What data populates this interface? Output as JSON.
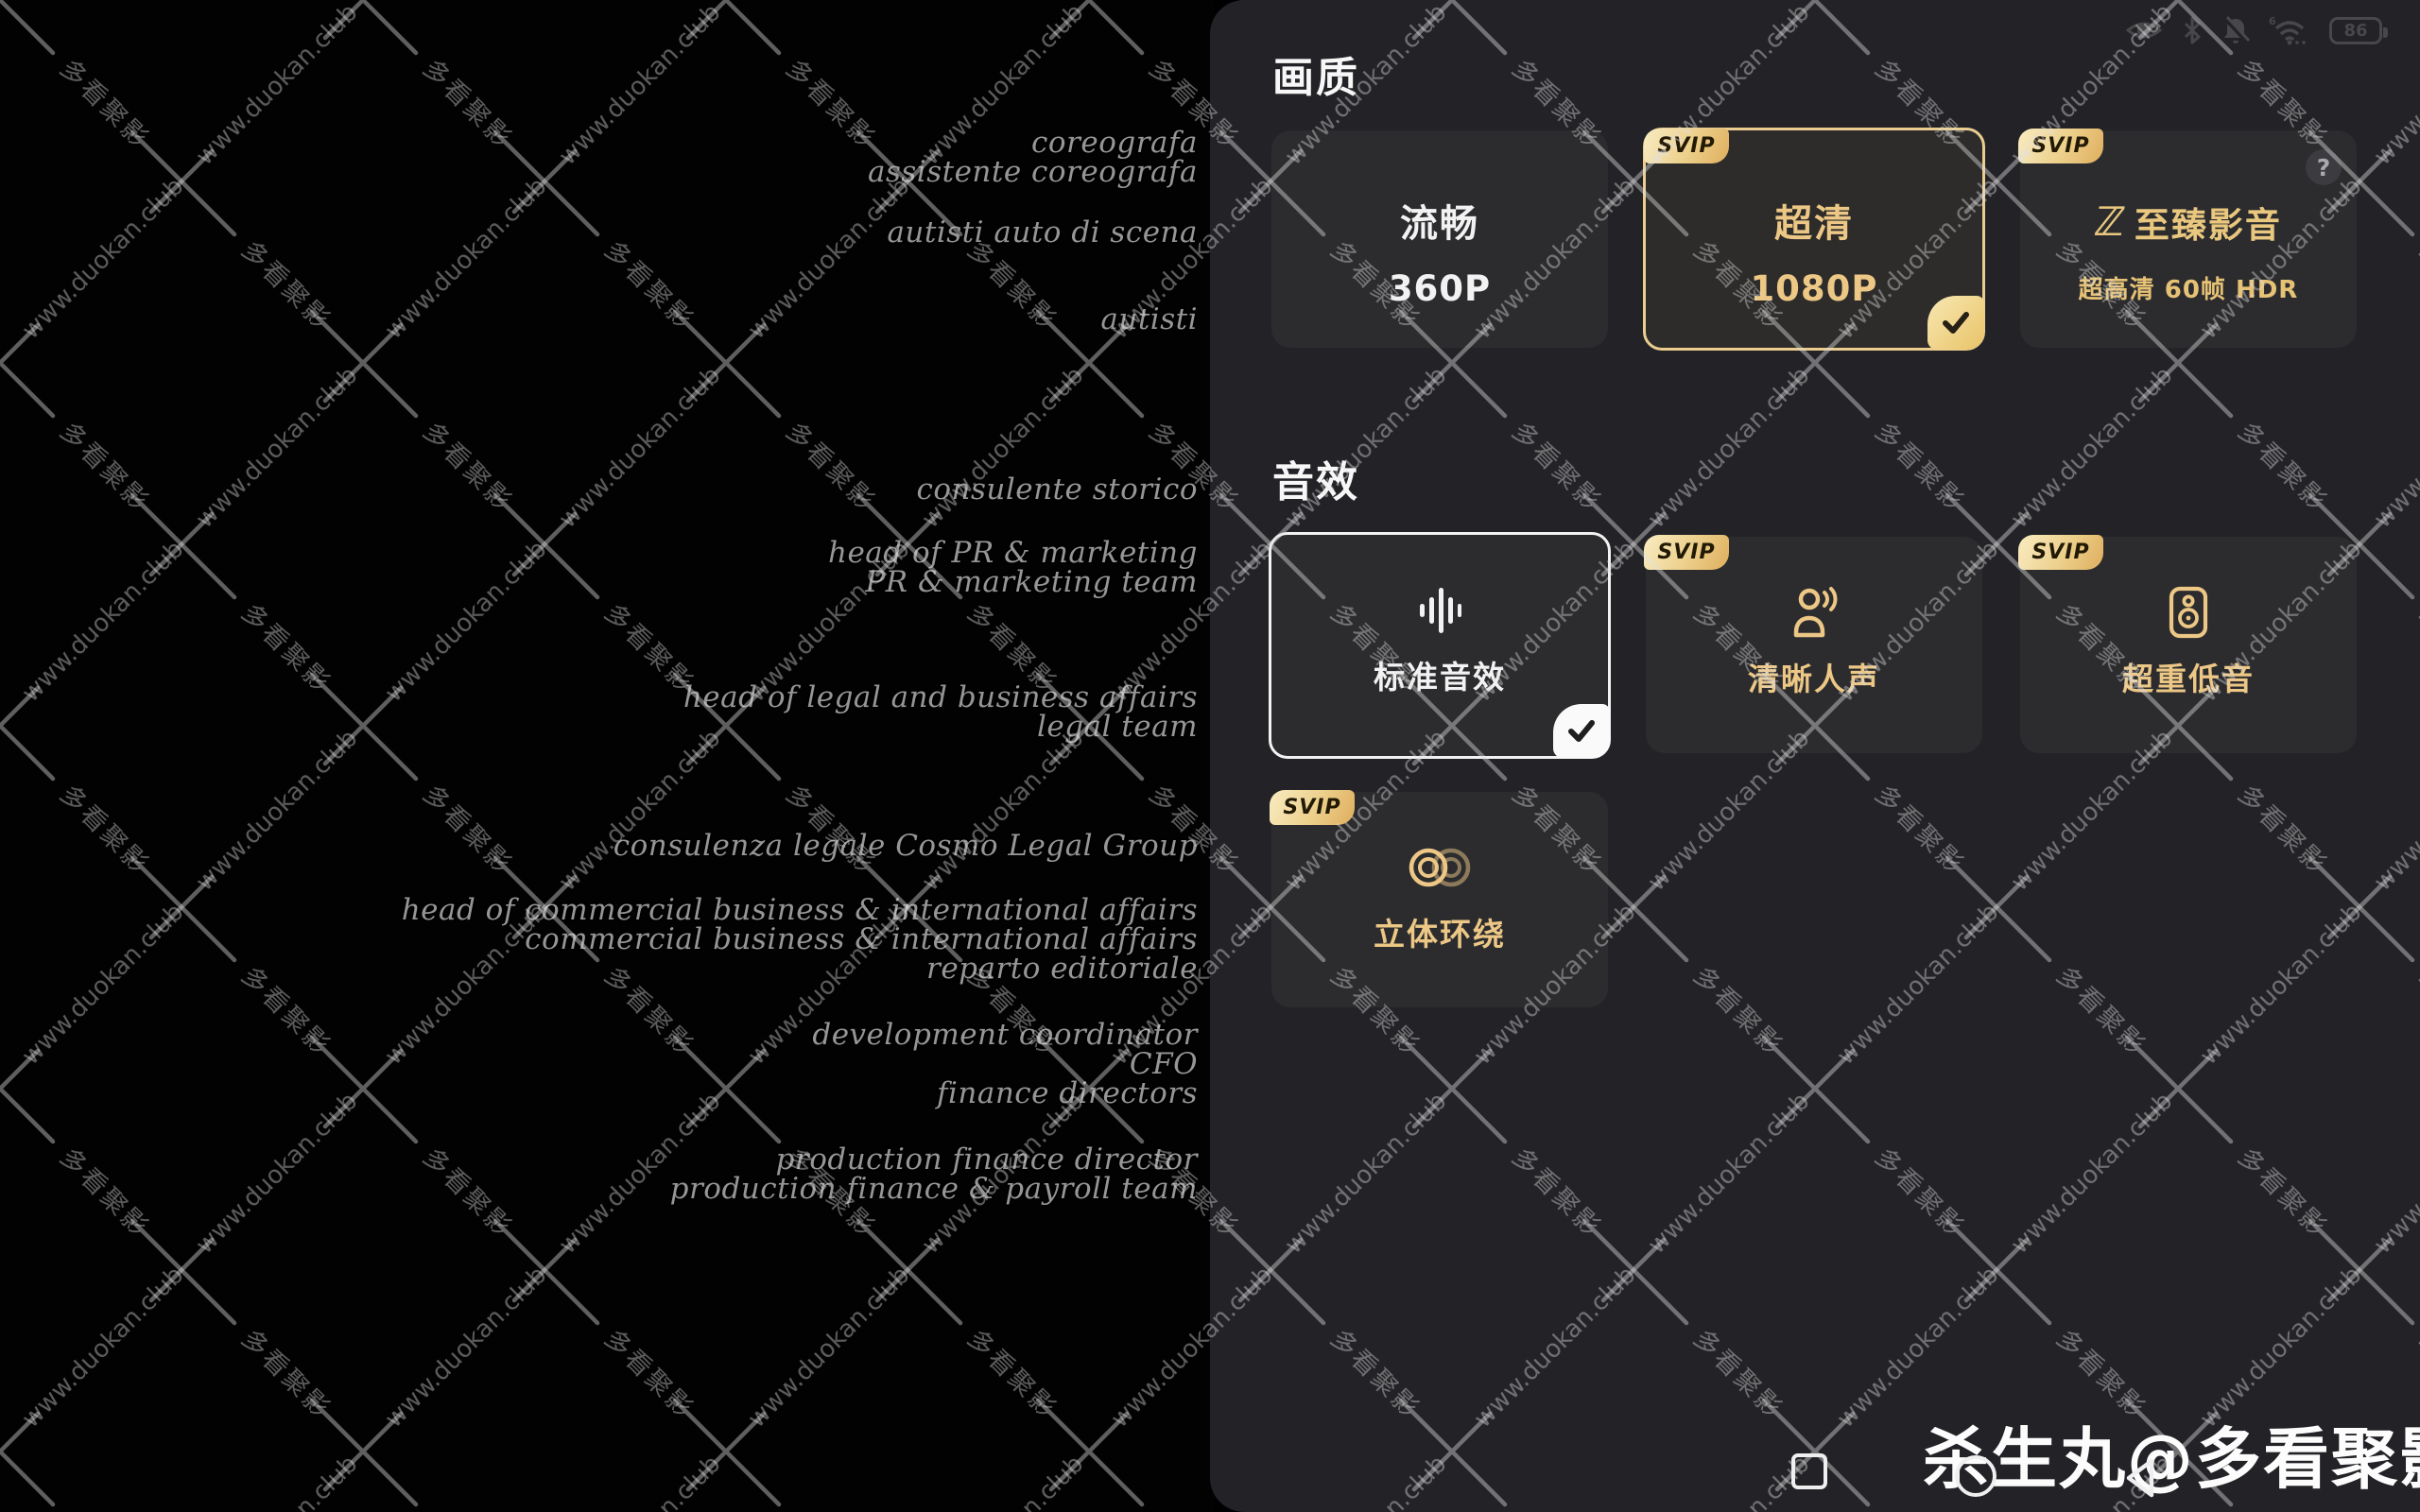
{
  "status_bar": {
    "battery": "86",
    "wifi_label": "6",
    "icons": [
      "eye",
      "bluetooth",
      "mute-bell",
      "wifi",
      "battery"
    ]
  },
  "panel": {
    "svip_label": "SVIP",
    "help_label": "?",
    "quality": {
      "title": "画质",
      "cards": [
        {
          "label": "流畅",
          "sublabel": "360P",
          "selected": false,
          "svip": false
        },
        {
          "label": "超清",
          "sublabel": "1080P",
          "selected": true,
          "svip": true
        },
        {
          "label": "至臻影音",
          "logo": "ℤ",
          "sublabel": "超高清 60帧 HDR",
          "selected": false,
          "svip": true
        }
      ]
    },
    "audio": {
      "title": "音效",
      "cards": [
        {
          "label": "标准音效",
          "icon": "equalizer",
          "selected": true,
          "svip": false
        },
        {
          "label": "清晰人声",
          "icon": "voice",
          "selected": false,
          "svip": true
        },
        {
          "label": "超重低音",
          "icon": "subwoofer",
          "selected": false,
          "svip": true
        },
        {
          "label": "立体环绕",
          "icon": "surround-rings",
          "selected": false,
          "svip": true
        }
      ]
    }
  },
  "credits": {
    "groups": [
      [
        "coreografa",
        "assistente coreografa"
      ],
      [
        "autisti auto di scena"
      ],
      [
        "autisti"
      ],
      [
        "consulente storico"
      ],
      [
        "head of PR & marketing",
        "PR & marketing team"
      ],
      [
        "head of legal and business affairs",
        "legal team"
      ],
      [
        "consulenza legale Cosmo Legal Group"
      ],
      [
        "head of commercial business & international affairs",
        "commercial business & international affairs",
        "reparto editoriale"
      ],
      [
        "development coordinator",
        "CFO",
        "finance directors"
      ],
      [
        "production finance director",
        "production finance & payroll team"
      ]
    ]
  },
  "watermark": {
    "url_text": "www.duokan.club",
    "brand_text": "多看聚影",
    "signature": "杀生丸@多看聚影"
  },
  "colors": {
    "gold_text": "#ecc785",
    "gold_border": "#ebcd8f",
    "panel_bg": "#232327",
    "card_bg": "#2c2c2f",
    "badge_gradient_start": "#f9ecc2",
    "badge_gradient_end": "#dfae5e"
  }
}
